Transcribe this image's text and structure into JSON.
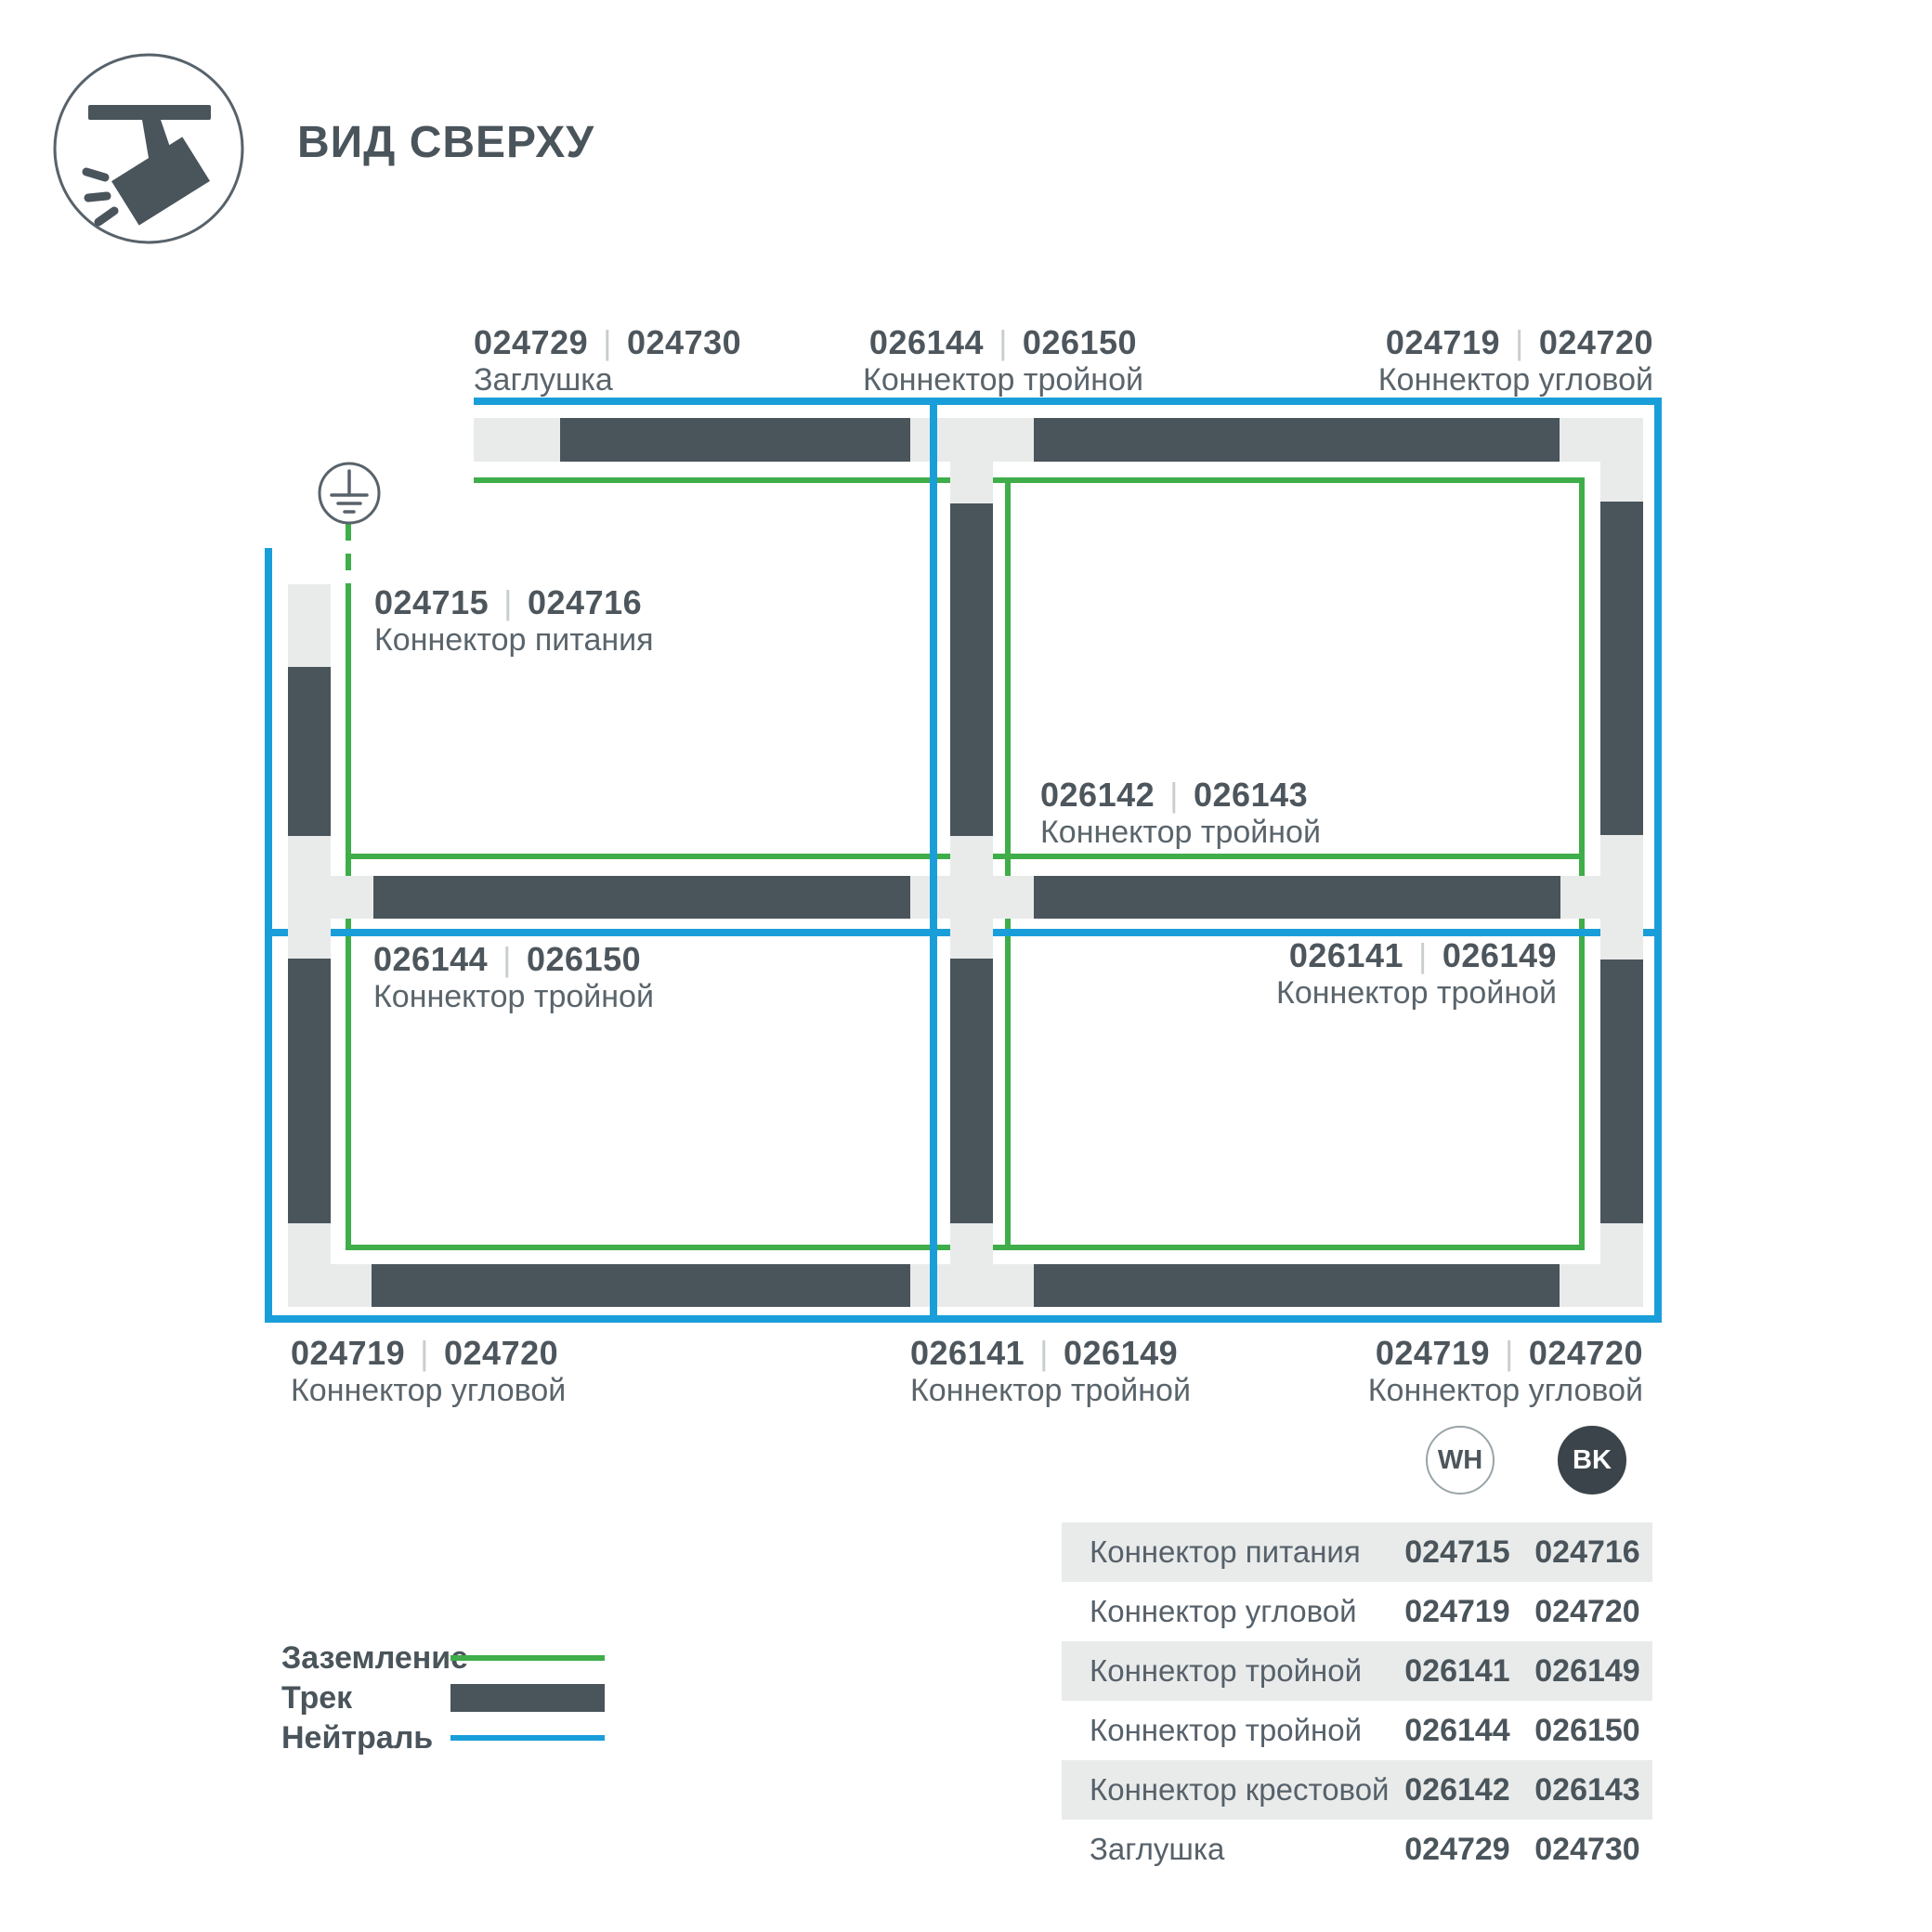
{
  "header": {
    "title": "ВИД СВЕРХУ",
    "icon": "track-spotlight"
  },
  "colors": {
    "track": "#4A545B",
    "track_base": "#E9EBEB",
    "ground": "#3FAD49",
    "neutral": "#1A9EDA",
    "text_dark": "#4D565C",
    "text_gray": "#5A646B",
    "bk_chip": "#3A444A",
    "row_stripe": "#E9EBEB"
  },
  "diagram": {
    "sep": "|",
    "labels": {
      "top_left": {
        "code_wh": "024729",
        "code_bk": "024730",
        "name": "Заглушка"
      },
      "top_center": {
        "code_wh": "026144",
        "code_bk": "026150",
        "name": "Коннектор тройной"
      },
      "top_right": {
        "code_wh": "024719",
        "code_bk": "024720",
        "name": "Коннектор угловой"
      },
      "power": {
        "code_wh": "024715",
        "code_bk": "024716",
        "name": "Коннектор питания"
      },
      "cross": {
        "code_wh": "026142",
        "code_bk": "026143",
        "name": "Коннектор тройной"
      },
      "mid_left": {
        "code_wh": "026144",
        "code_bk": "026150",
        "name": "Коннектор тройной"
      },
      "mid_right": {
        "code_wh": "026141",
        "code_bk": "026149",
        "name": "Коннектор тройной"
      },
      "bottom_left": {
        "code_wh": "024719",
        "code_bk": "024720",
        "name": "Коннектор угловой"
      },
      "bottom_center": {
        "code_wh": "026141",
        "code_bk": "026149",
        "name": "Коннектор тройной"
      },
      "bottom_right": {
        "code_wh": "024719",
        "code_bk": "024720",
        "name": "Коннектор угловой"
      }
    }
  },
  "legend": {
    "items": [
      {
        "label": "Заземление"
      },
      {
        "label": "Трек"
      },
      {
        "label": "Нейтраль"
      }
    ]
  },
  "table": {
    "columns": {
      "wh": "WH",
      "bk": "BK"
    },
    "rows": [
      {
        "name": "Коннектор питания",
        "wh": "024715",
        "bk": "024716"
      },
      {
        "name": "Коннектор угловой",
        "wh": "024719",
        "bk": "024720"
      },
      {
        "name": "Коннектор тройной",
        "wh": "026141",
        "bk": "026149"
      },
      {
        "name": "Коннектор тройной",
        "wh": "026144",
        "bk": "026150"
      },
      {
        "name": "Коннектор крестовой",
        "wh": "026142",
        "bk": "026143"
      },
      {
        "name": "Заглушка",
        "wh": "024729",
        "bk": "024730"
      }
    ]
  }
}
